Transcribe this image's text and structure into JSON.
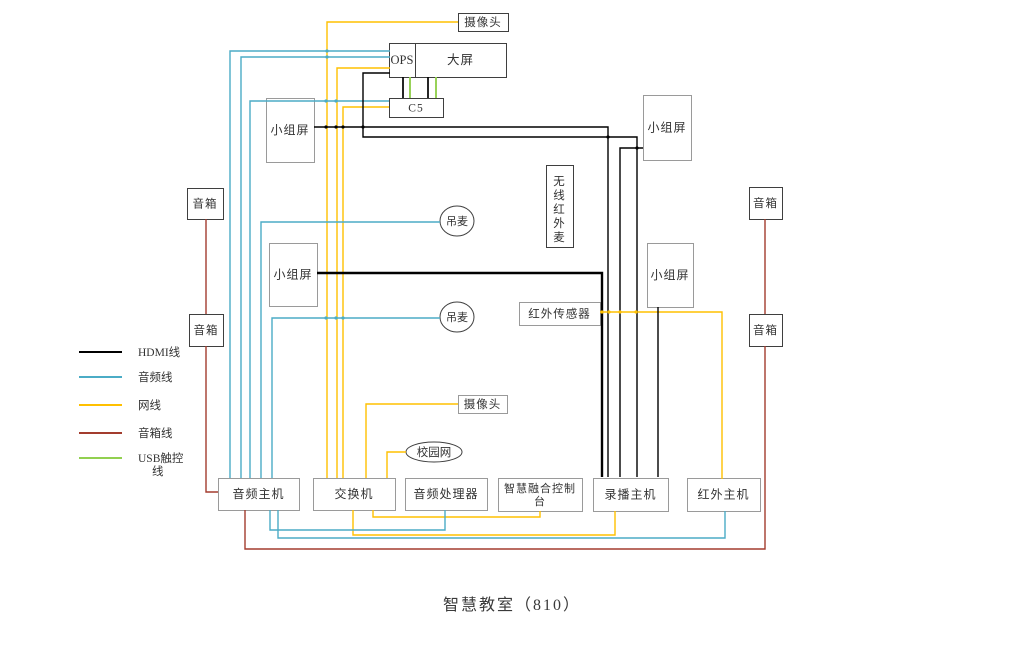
{
  "title": "智慧教室（810）",
  "colors": {
    "hdmi": "#000000",
    "audio": "#4BACC6",
    "net": "#FFC000",
    "speaker": "#A33C2E",
    "usb": "#92D050"
  },
  "legend": {
    "swatch_x1": 79,
    "swatch_x2": 122,
    "label_x": 138,
    "items": [
      {
        "label": "HDMI线",
        "color": "hdmi",
        "y": 352
      },
      {
        "label": "音频线",
        "color": "audio",
        "y": 377
      },
      {
        "label": "网线",
        "color": "net",
        "y": 405
      },
      {
        "label": "音箱线",
        "color": "speaker",
        "y": 433
      },
      {
        "label": "USB触控|线",
        "color": "usb",
        "y": 458,
        "line_gap": 13
      }
    ]
  },
  "nodes": [
    {
      "id": "camera-top",
      "label": "摄像头",
      "shape": "rect",
      "x": 458,
      "y": 13,
      "w": 50,
      "h": 18,
      "border": "dark",
      "fs": 11.5
    },
    {
      "id": "main-screen",
      "label": "大屏",
      "sublabel": "OPS",
      "shape": "rect",
      "x": 389,
      "y": 43,
      "w": 117,
      "h": 34,
      "divider_x": 415,
      "border": "dark",
      "fs": 12.5
    },
    {
      "id": "c5",
      "label": "C5",
      "shape": "rect",
      "x": 389,
      "y": 98,
      "w": 54,
      "h": 19,
      "border": "dark",
      "fs": 11.5
    },
    {
      "id": "group-screen-left-top",
      "label": "小组屏",
      "shape": "rect",
      "x": 266,
      "y": 98,
      "w": 48,
      "h": 64,
      "border": "gray",
      "fs": 12
    },
    {
      "id": "group-screen-right-top",
      "label": "小组屏",
      "shape": "rect",
      "x": 643,
      "y": 95,
      "w": 48,
      "h": 65,
      "border": "gray",
      "fs": 12
    },
    {
      "id": "speaker-left-top",
      "label": "音箱",
      "shape": "rect",
      "x": 187,
      "y": 188,
      "w": 36,
      "h": 31,
      "border": "dark",
      "fs": 11.5
    },
    {
      "id": "speaker-right-top",
      "label": "音箱",
      "shape": "rect",
      "x": 749,
      "y": 187,
      "w": 33,
      "h": 32,
      "border": "dark",
      "fs": 11.5
    },
    {
      "id": "wireless-ir-mic",
      "label": "无线红外麦",
      "shape": "rect",
      "x": 546,
      "y": 165,
      "w": 27,
      "h": 82,
      "border": "dark",
      "vertical": true,
      "fs": 11.5
    },
    {
      "id": "ceiling-mic-1",
      "label": "吊麦",
      "shape": "ellipse",
      "x": 457,
      "y": 221,
      "rx": 17,
      "ry": 15,
      "border": "dark",
      "fs": 11
    },
    {
      "id": "group-screen-left-mid",
      "label": "小组屏",
      "shape": "rect",
      "x": 269,
      "y": 243,
      "w": 48,
      "h": 63,
      "border": "gray",
      "fs": 12
    },
    {
      "id": "group-screen-right-mid",
      "label": "小组屏",
      "shape": "rect",
      "x": 647,
      "y": 243,
      "w": 46,
      "h": 64,
      "border": "gray",
      "fs": 12
    },
    {
      "id": "ceiling-mic-2",
      "label": "吊麦",
      "shape": "ellipse",
      "x": 457,
      "y": 317,
      "rx": 17,
      "ry": 15,
      "border": "dark",
      "fs": 11
    },
    {
      "id": "ir-sensor",
      "label": "红外传感器",
      "shape": "rect",
      "x": 519,
      "y": 302,
      "w": 81,
      "h": 23,
      "border": "gray",
      "fs": 11.5
    },
    {
      "id": "speaker-left-bottom",
      "label": "音箱",
      "shape": "rect",
      "x": 189,
      "y": 314,
      "w": 34,
      "h": 32,
      "border": "dark",
      "fs": 11.5
    },
    {
      "id": "speaker-right-bottom",
      "label": "音箱",
      "shape": "rect",
      "x": 749,
      "y": 314,
      "w": 33,
      "h": 32,
      "border": "dark",
      "fs": 11.5
    },
    {
      "id": "camera-mid",
      "label": "摄像头",
      "shape": "rect",
      "x": 458,
      "y": 395,
      "w": 49,
      "h": 18,
      "border": "gray",
      "fs": 11.5
    },
    {
      "id": "campus-network",
      "label": "校园网",
      "shape": "ellipse",
      "x": 434,
      "y": 452,
      "rx": 28,
      "ry": 10,
      "border": "dark",
      "fs": 11.5
    },
    {
      "id": "audio-host",
      "label": "音频主机",
      "shape": "rect",
      "x": 218,
      "y": 478,
      "w": 81,
      "h": 32,
      "border": "gray",
      "fs": 12
    },
    {
      "id": "network-switch",
      "label": "交换机",
      "shape": "rect",
      "x": 313,
      "y": 478,
      "w": 82,
      "h": 32,
      "border": "gray",
      "fs": 12
    },
    {
      "id": "audio-processor",
      "label": "音频处理器",
      "shape": "rect",
      "x": 405,
      "y": 478,
      "w": 82,
      "h": 32,
      "border": "gray",
      "fs": 12
    },
    {
      "id": "fusion-console",
      "label": "智慧融合控制|台",
      "shape": "rect",
      "x": 498,
      "y": 478,
      "w": 84,
      "h": 33,
      "border": "gray",
      "fs": 11,
      "line_gap": 13
    },
    {
      "id": "recording-host",
      "label": "录播主机",
      "shape": "rect",
      "x": 593,
      "y": 478,
      "w": 75,
      "h": 33,
      "border": "gray",
      "fs": 12
    },
    {
      "id": "ir-host",
      "label": "红外主机",
      "shape": "rect",
      "x": 687,
      "y": 478,
      "w": 73,
      "h": 33,
      "border": "gray",
      "fs": 12
    }
  ],
  "edges": [
    {
      "name": "net-camera-top-to-switch",
      "color": "net",
      "points": [
        [
          458,
          22
        ],
        [
          327,
          22
        ],
        [
          327,
          478
        ]
      ]
    },
    {
      "name": "net-ops-to-switch",
      "color": "net",
      "points": [
        [
          390,
          68
        ],
        [
          337,
          68
        ],
        [
          337,
          478
        ]
      ]
    },
    {
      "name": "net-c5-to-switch",
      "color": "net",
      "points": [
        [
          389,
          107
        ],
        [
          343,
          107
        ],
        [
          343,
          478
        ]
      ]
    },
    {
      "name": "net-camera-mid-to-switch",
      "color": "net",
      "points": [
        [
          458,
          404
        ],
        [
          366,
          404
        ],
        [
          366,
          478
        ]
      ]
    },
    {
      "name": "net-campus-network-to-switch",
      "color": "net",
      "points": [
        [
          406,
          452
        ],
        [
          387,
          452
        ],
        [
          387,
          478
        ]
      ]
    },
    {
      "name": "net-switch-to-fusion-console",
      "color": "net",
      "points": [
        [
          373,
          510
        ],
        [
          373,
          517
        ],
        [
          540,
          517
        ],
        [
          540,
          511
        ]
      ]
    },
    {
      "name": "net-switch-to-recording-host",
      "color": "net",
      "points": [
        [
          353,
          510
        ],
        [
          353,
          535
        ],
        [
          615,
          535
        ],
        [
          615,
          511
        ]
      ]
    },
    {
      "name": "net-ir-sensor-to-ir-host",
      "color": "net",
      "points": [
        [
          600,
          312
        ],
        [
          722,
          312
        ],
        [
          722,
          479
        ]
      ]
    },
    {
      "name": "audio-screen-line-1",
      "color": "audio",
      "points": [
        [
          390,
          51
        ],
        [
          230,
          51
        ],
        [
          230,
          478
        ]
      ]
    },
    {
      "name": "audio-screen-line-2",
      "color": "audio",
      "points": [
        [
          390,
          57
        ],
        [
          241,
          57
        ],
        [
          241,
          478
        ]
      ]
    },
    {
      "name": "audio-c5-line",
      "color": "audio",
      "points": [
        [
          389,
          101
        ],
        [
          250,
          101
        ],
        [
          250,
          478
        ]
      ]
    },
    {
      "name": "audio-ceiling-mic-1",
      "color": "audio",
      "points": [
        [
          440,
          222
        ],
        [
          261,
          222
        ],
        [
          261,
          478
        ]
      ]
    },
    {
      "name": "audio-ceiling-mic-2",
      "color": "audio",
      "points": [
        [
          440,
          318
        ],
        [
          272,
          318
        ],
        [
          272,
          478
        ]
      ]
    },
    {
      "name": "audio-host-to-processor",
      "color": "audio",
      "points": [
        [
          270,
          510
        ],
        [
          270,
          530
        ],
        [
          445,
          530
        ],
        [
          445,
          510
        ]
      ]
    },
    {
      "name": "audio-host-to-ir-host",
      "color": "audio",
      "points": [
        [
          278,
          510
        ],
        [
          278,
          538
        ],
        [
          725,
          538
        ],
        [
          725,
          511
        ]
      ]
    },
    {
      "name": "speaker-left-link",
      "color": "speaker",
      "points": [
        [
          206,
          219
        ],
        [
          206,
          314
        ]
      ]
    },
    {
      "name": "speaker-left-to-audio-host",
      "color": "speaker",
      "points": [
        [
          206,
          346
        ],
        [
          206,
          492
        ],
        [
          218,
          492
        ]
      ]
    },
    {
      "name": "speaker-right-to-audio-host",
      "color": "speaker",
      "points": [
        [
          245,
          510
        ],
        [
          245,
          549
        ],
        [
          765,
          549
        ],
        [
          765,
          346
        ]
      ]
    },
    {
      "name": "speaker-right-link",
      "color": "speaker",
      "points": [
        [
          765,
          314
        ],
        [
          765,
          219
        ]
      ]
    },
    {
      "name": "hdmi-group-left-top",
      "color": "hdmi",
      "points": [
        [
          314,
          127
        ],
        [
          608,
          127
        ],
        [
          608,
          477
        ]
      ]
    },
    {
      "name": "hdmi-ops-to-recording-host",
      "color": "hdmi",
      "points": [
        [
          390,
          73
        ],
        [
          363,
          73
        ],
        [
          363,
          137
        ],
        [
          637,
          137
        ],
        [
          637,
          477
        ]
      ]
    },
    {
      "name": "hdmi-group-right-top",
      "color": "hdmi",
      "points": [
        [
          643,
          148
        ],
        [
          620,
          148
        ],
        [
          620,
          477
        ]
      ]
    },
    {
      "name": "hdmi-group-left-mid",
      "color": "hdmi",
      "w": 2.4,
      "points": [
        [
          317,
          273
        ],
        [
          602,
          273
        ],
        [
          602,
          477
        ]
      ]
    },
    {
      "name": "hdmi-group-right-mid",
      "color": "hdmi",
      "points": [
        [
          658,
          307
        ],
        [
          658,
          477
        ]
      ]
    },
    {
      "name": "hdmi-screen-c5-1",
      "color": "hdmi",
      "w": 1.7,
      "points": [
        [
          403,
          77
        ],
        [
          403,
          98
        ]
      ]
    },
    {
      "name": "hdmi-screen-c5-2",
      "color": "hdmi",
      "w": 1.7,
      "points": [
        [
          428,
          77
        ],
        [
          428,
          98
        ]
      ]
    },
    {
      "name": "usb-screen-c5-1",
      "color": "usb",
      "w": 1.9,
      "points": [
        [
          410,
          77
        ],
        [
          410,
          98
        ]
      ]
    },
    {
      "name": "usb-screen-c5-2",
      "color": "usb",
      "w": 1.9,
      "points": [
        [
          436,
          77
        ],
        [
          436,
          98
        ]
      ]
    }
  ],
  "dots": [
    {
      "x": 363,
      "y": 127,
      "color": "hdmi"
    },
    {
      "x": 608,
      "y": 137,
      "color": "hdmi"
    },
    {
      "x": 637,
      "y": 148,
      "color": "hdmi"
    },
    {
      "x": 326,
      "y": 101,
      "color": "audio"
    },
    {
      "x": 336,
      "y": 101,
      "color": "audio"
    },
    {
      "x": 327,
      "y": 51,
      "color": "audio"
    },
    {
      "x": 327,
      "y": 57,
      "color": "audio"
    },
    {
      "x": 326,
      "y": 127,
      "color": "hdmi"
    },
    {
      "x": 336,
      "y": 127,
      "color": "hdmi"
    },
    {
      "x": 343,
      "y": 127,
      "color": "hdmi"
    },
    {
      "x": 326,
      "y": 318,
      "color": "audio"
    },
    {
      "x": 336,
      "y": 318,
      "color": "audio"
    },
    {
      "x": 343,
      "y": 318,
      "color": "audio"
    },
    {
      "x": 602,
      "y": 312,
      "color": "net"
    },
    {
      "x": 609,
      "y": 312,
      "color": "net"
    },
    {
      "x": 620,
      "y": 312,
      "color": "net"
    },
    {
      "x": 636,
      "y": 312,
      "color": "net"
    }
  ]
}
